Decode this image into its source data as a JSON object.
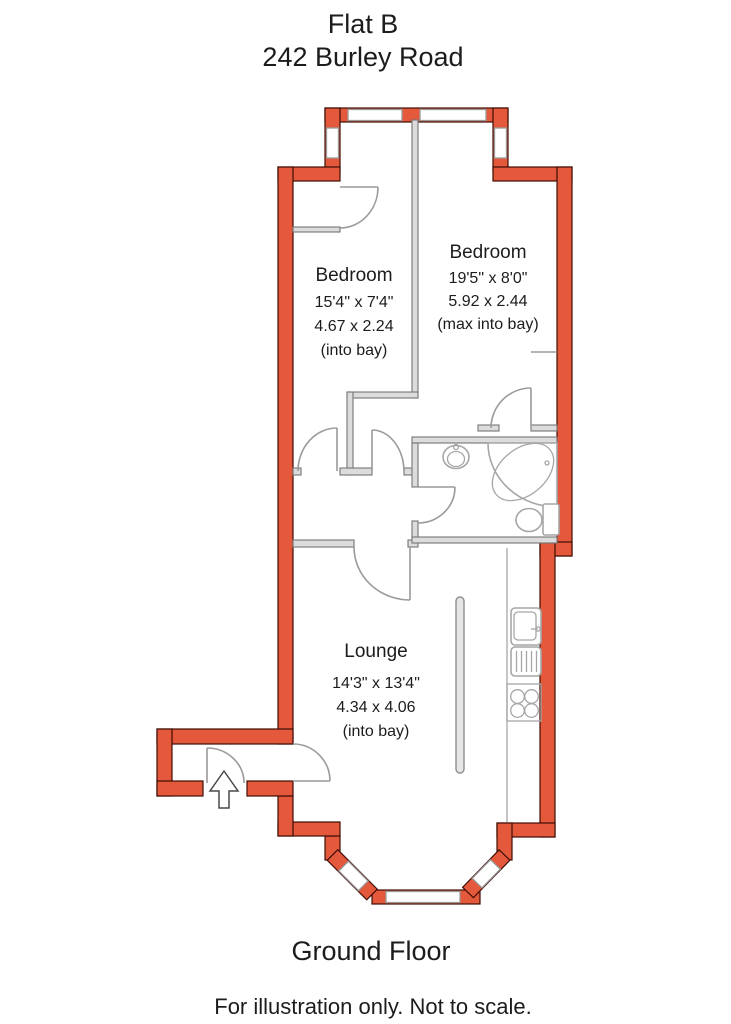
{
  "title": {
    "line1": "Flat B",
    "line2": "242 Burley Road"
  },
  "rooms": [
    {
      "name": "Bedroom",
      "dim_imperial": "15'4\" x 7'4\"",
      "dim_metric": "4.67 x 2.24",
      "note": "(into bay)"
    },
    {
      "name": "Bedroom",
      "dim_imperial": "19'5\" x 8'0\"",
      "dim_metric": "5.92 x 2.44",
      "note": "(max into bay)"
    },
    {
      "name": "Lounge",
      "dim_imperial": "14'3\" x 13'4\"",
      "dim_metric": "4.34 x 4.06",
      "note": "(into bay)"
    }
  ],
  "footer": {
    "floor_label": "Ground Floor",
    "disclaimer": "For illustration only. Not to scale."
  },
  "icons": [
    "entrance-arrow-icon",
    "bath-icon",
    "toilet-icon",
    "basin-icon",
    "kitchen-sink-icon",
    "hob-icon"
  ],
  "colors": {
    "wall": "#e4593b",
    "wall_edge": "#3f0d05",
    "window": "#ffffff",
    "window_frame": "#999999",
    "interior_wall": "#dcdcdc",
    "fixture": "#a6a6a6",
    "text": "#1c1c1c",
    "background": "#ffffff"
  }
}
